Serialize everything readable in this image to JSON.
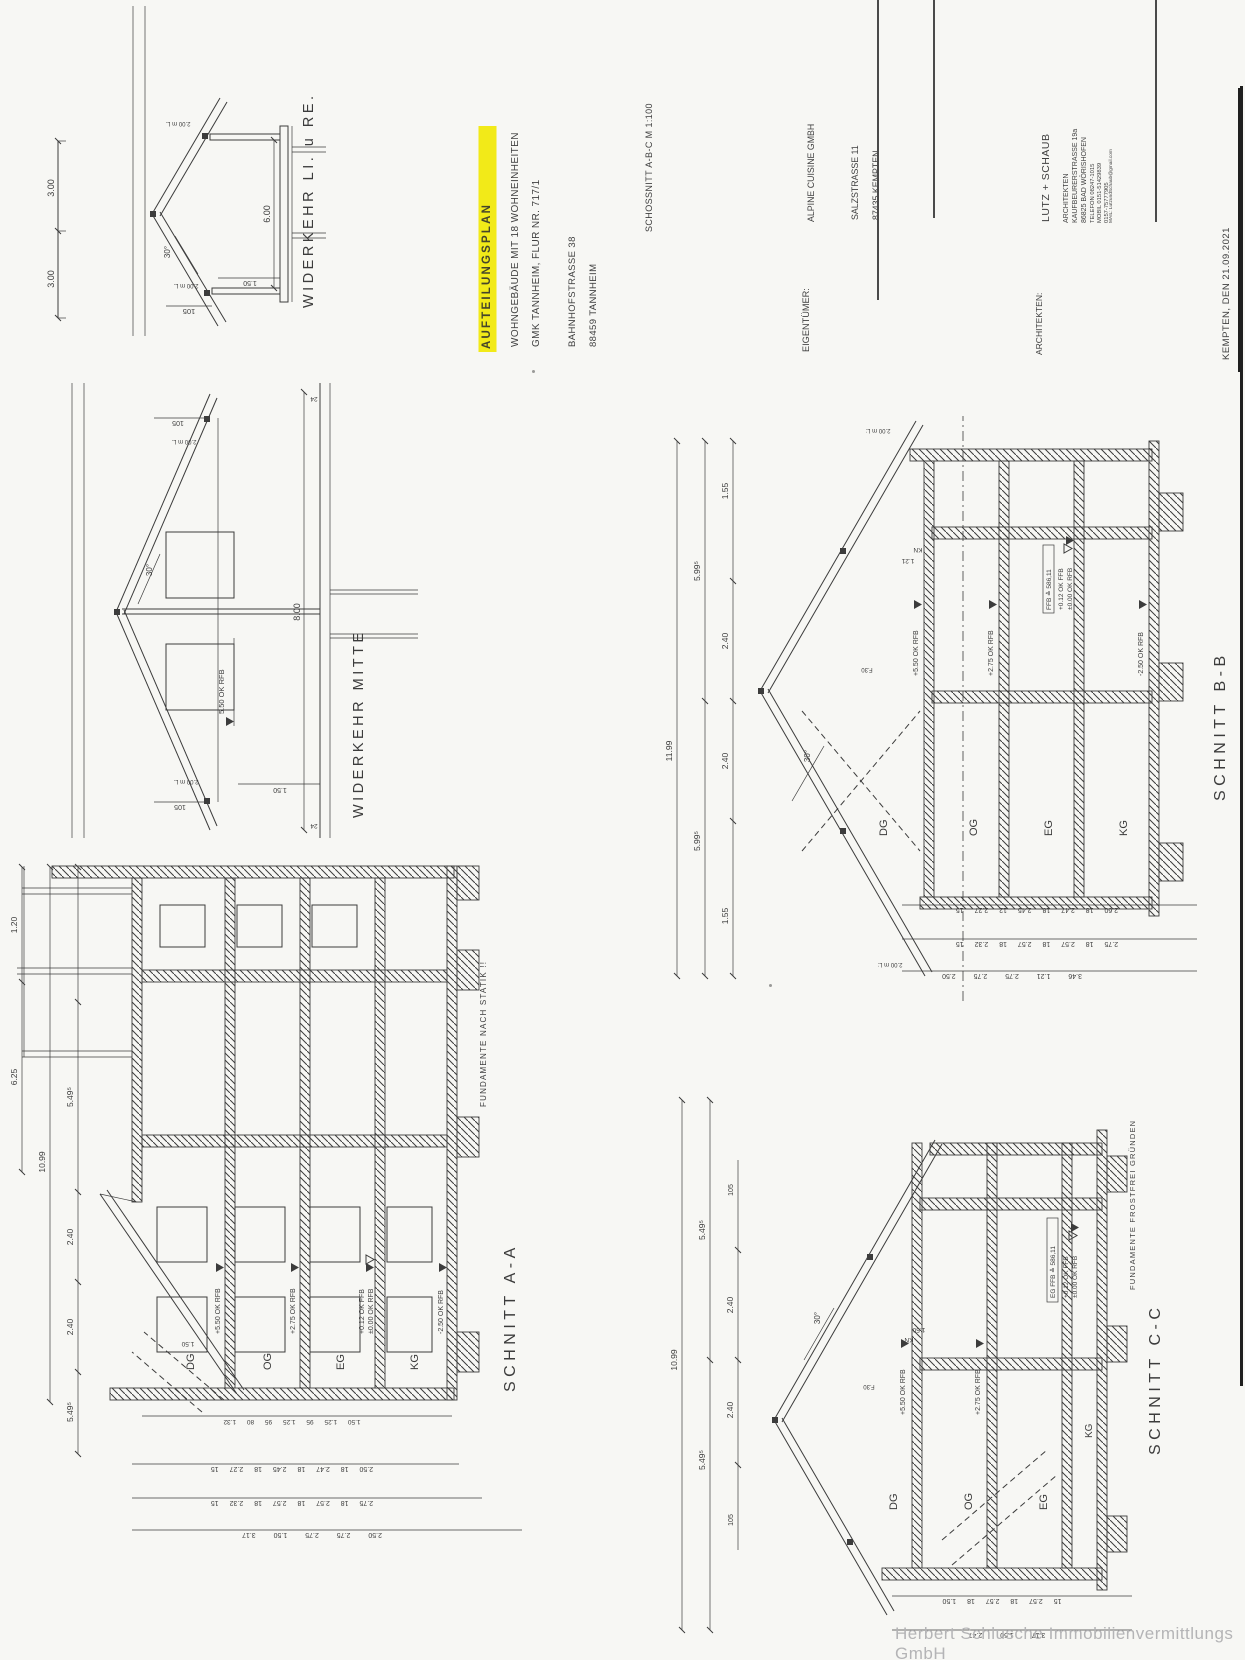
{
  "colors": {
    "ink": "#3c3c3c",
    "paper": "#f7f7f4",
    "highlight": "#f2ea18",
    "watermark": "#b4b4b6"
  },
  "title_block": {
    "title": "AUFTEILUNGSPLAN",
    "line1": "WOHNGEBÄUDE MIT 18 WOHNEINHEITEN",
    "line2": "GMK TANNHEIM, FLUR NR. 717/1",
    "line3": "BAHNHOFSTRASSE 38",
    "line4": "88459 TANNHEIM",
    "sheet": "SCHOSSNITT A-B-C  M 1:100",
    "owner_label": "EIGENTÜMER:",
    "owner_name": "ALPINE CUISINE GMBH",
    "owner_addr1": "SALZSTRASSE 11",
    "owner_addr2": "87435 KEMPTEN",
    "arch_label": "ARCHITEKTEN:",
    "arch_name": "LUTZ + SCHAUB",
    "arch_sub": "ARCHITEKTEN",
    "arch_addr1": "KAUFBEURERSTRASSE 19a",
    "arch_addr2": "86825  BAD WÖRISHOFEN",
    "arch_tel": "TELEFON   08247-1015",
    "arch_mobil1": "MOBIL       0151-51429839",
    "arch_mobil2": "              0157-75777905",
    "arch_mail": "MAIL: LutzundSchaub@gmail.com",
    "date_line": "KEMPTEN,  DEN 21.09.2021"
  },
  "watermark": "Herbert Schlusche Immobilienvermittlungs GmbH",
  "wlr": {
    "title": "WIDERKEHR  LI. u RE.",
    "d300a": "3.00",
    "d300b": "3.00",
    "d105": "105",
    "d200a": "2.00 m L.",
    "d200b": "2.00 m L.",
    "deg": "30°",
    "d150": "1.50",
    "d600": "6.00"
  },
  "wm": {
    "title": "WIDERKEHR  MITTE",
    "d105a": "105",
    "d105b": "105",
    "d200a": "2.00 m L.",
    "d200b": "2.00 m L.",
    "deg": "30°",
    "level": "5.50 OK RFB",
    "d150": "1.50",
    "d800": "8.00",
    "d24a": "24",
    "d24b": "24"
  },
  "aa": {
    "title": "SCHNITT A-A",
    "fund": "FUNDAMENTE NACH STATIK !!",
    "floors": [
      "DG",
      "OG",
      "EG",
      "KG"
    ],
    "levels": [
      "+5.50 OK RFB",
      "+2.75 OK RFB",
      "+0.12 OK FFB",
      "±0.00 OK RFB",
      "-2.50 OK RFB"
    ],
    "top": [
      "6.25",
      "1.20",
      "10.99",
      "5.49⁵",
      "2.40",
      "2.40",
      "5.49⁵"
    ],
    "chains": [
      "2.50 18 2.47 18 2.45 18 2.27 15",
      "2.75 18 2.57 18 2.57 18 2.32 15",
      "2.50 2.75 2.75 1.50 3.17"
    ],
    "inner": "1.50 1.25 95 1.25 95 80 1.32",
    "d150": "1.50"
  },
  "bb": {
    "title": "SCHNITT B-B",
    "floors": [
      "DG",
      "OG",
      "EG",
      "KG"
    ],
    "levels": [
      "+5.50 OK RFB",
      "+2.75 OK RFB",
      "FFB ≙ 586,11",
      "+0.12 OK FFB",
      "±0.00 OK RFB",
      "-2.50 OK RFB"
    ],
    "top": [
      "11.99",
      "5.99⁵",
      "5.99⁵",
      "2.40",
      "2.40",
      "1.55",
      "1.55"
    ],
    "deg": "30°",
    "d200a": "2.00 m L:",
    "d200b": "2.00 m L:",
    "kn": "KN",
    "d121": "1.21",
    "f30": "F.30",
    "chains": [
      "2.60 18 2.47 18 2.45 12 2.27 15",
      "2.75 18 2.57 18 2.57 18 2.32 15",
      "3.46 1.21 2.75 2.75 2.50"
    ]
  },
  "cc": {
    "title": "SCHNITT C-C",
    "fund": "FUNDAMENTE FROSTFREI GRÜNDEN",
    "floors": [
      "DG",
      "OG",
      "EG",
      "KG"
    ],
    "levels": [
      "+5.50 OK RFB",
      "+2.75 OK RFB",
      "EG FFB ≙ 586,11",
      "+0.12 OK FFB",
      "±0.00 OK RFB"
    ],
    "top": [
      "10.99",
      "5.49⁵",
      "5.49⁵",
      "2.40",
      "2.40",
      "105",
      "105"
    ],
    "deg": "30°",
    "kn": "KN",
    "d150": "1.50",
    "f30": "F.30",
    "chains": [
      "15 2.57 18 2.57 18 1.50",
      "3.17 1.50 2.47"
    ]
  }
}
